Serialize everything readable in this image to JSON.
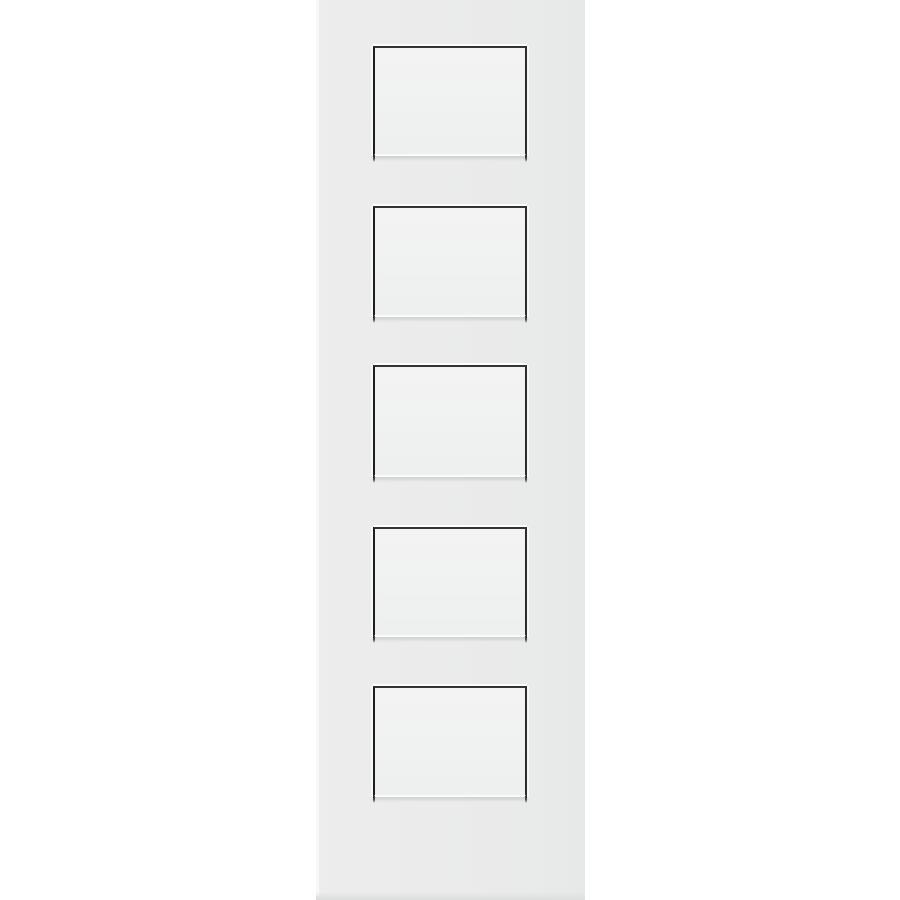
{
  "page": {
    "background_color": "#ffffff",
    "description": "Product photo of a white five-panel equal shaker-style interior door slab, shown flat against a plain white background with no text or UI controls"
  },
  "door": {
    "style": "5-panel equal shaker door slab",
    "panel_count": 5,
    "panels": [
      {
        "id": "panel-1"
      },
      {
        "id": "panel-2"
      },
      {
        "id": "panel-3"
      },
      {
        "id": "panel-4"
      },
      {
        "id": "panel-5"
      }
    ],
    "colors": {
      "door_face": "#ebebeb",
      "door_face_right_shade": "#e7e8e8",
      "panel_face": "#f0f1f1",
      "groove_shadow_dark": "#2c2c2c",
      "groove_highlight": "#ffffff",
      "bottom_edge_shadow": "#dedfdf"
    }
  }
}
